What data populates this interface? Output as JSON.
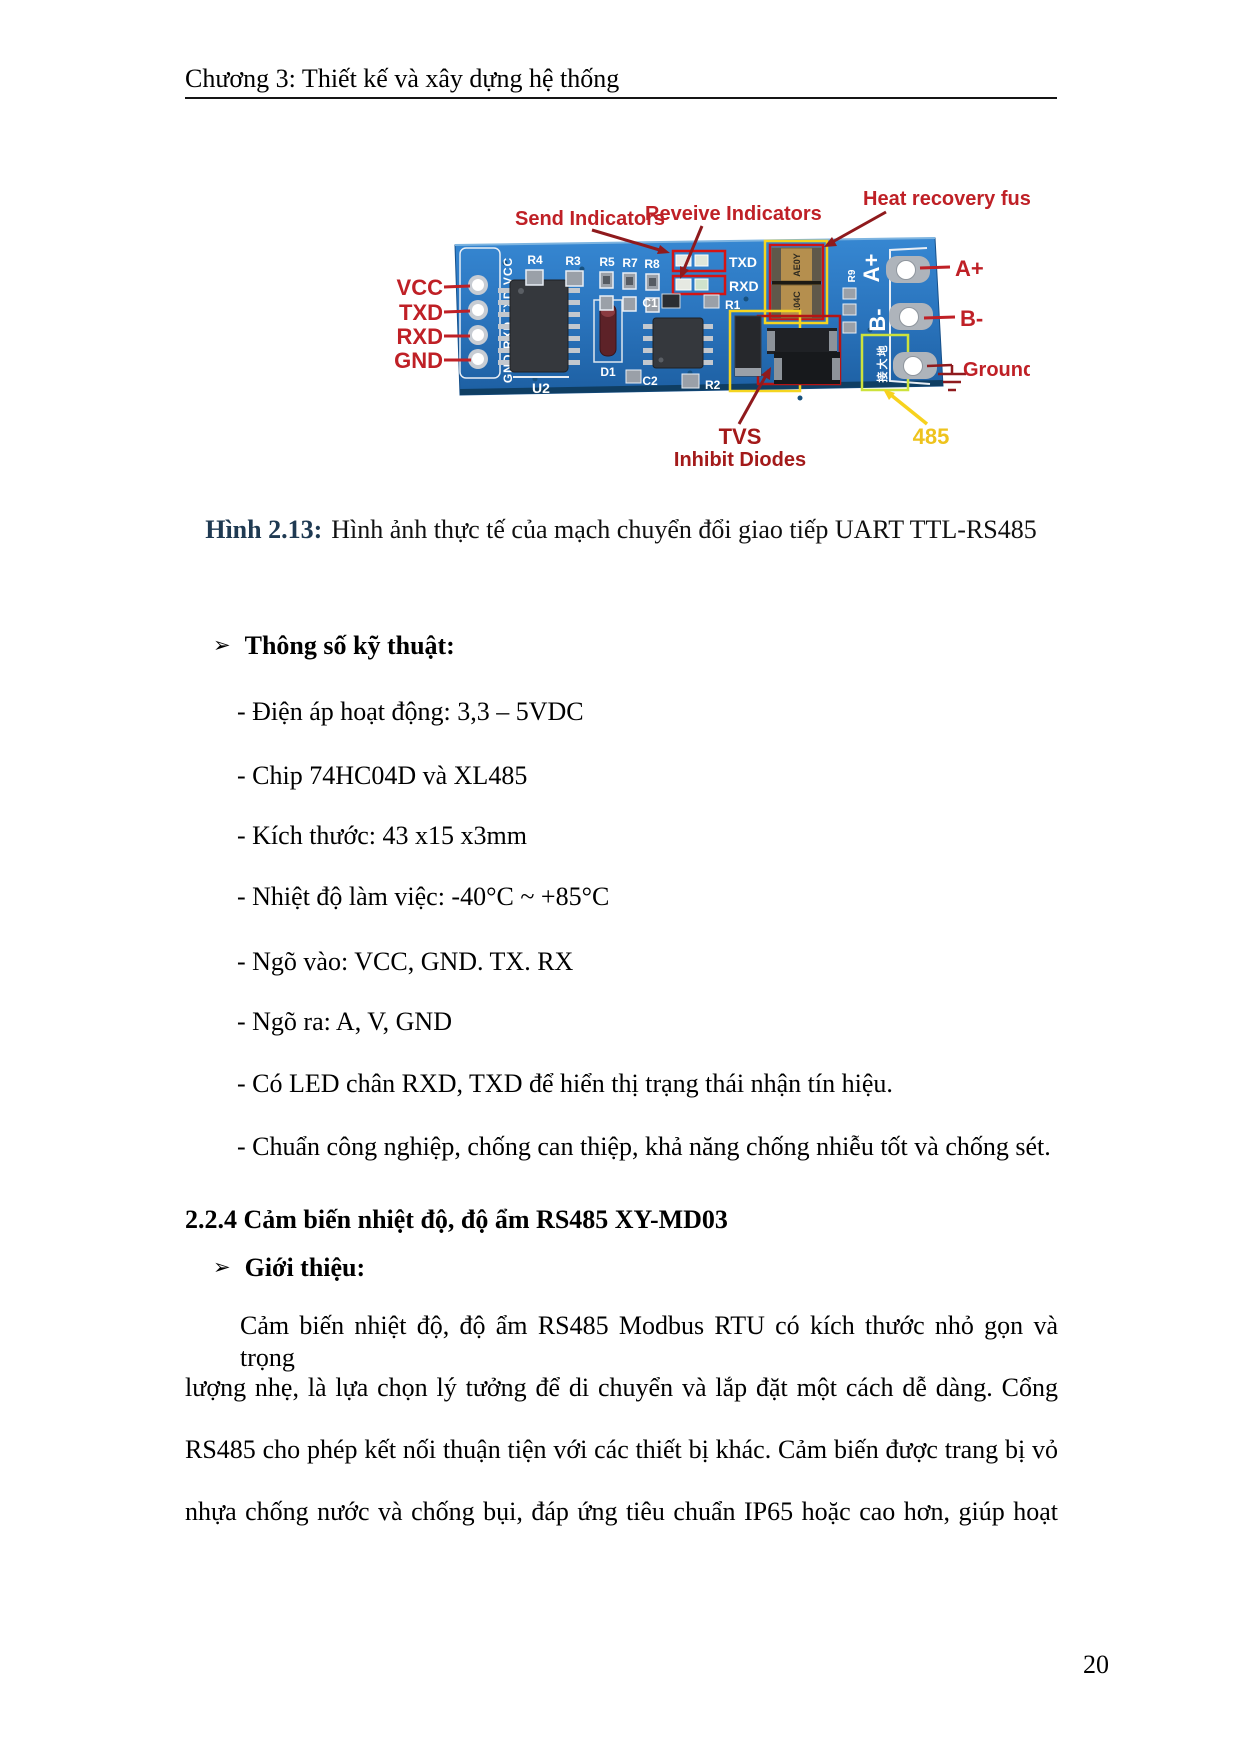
{
  "page": {
    "header": "Chương 3: Thiết kế và xây dựng hệ thống",
    "page_number": "20"
  },
  "figure": {
    "caption": {
      "label": "Hình 2.13:",
      "text": "Hình ảnh thực tế của mạch chuyển đổi giao tiếp UART TTL-RS485"
    },
    "labels": {
      "send": "Send Indicators",
      "receive": "Reveive Indicators",
      "fuse": "Heat recovery fuse",
      "vcc": "VCC",
      "txd": "TXD",
      "rxd": "RXD",
      "gnd": "GND",
      "a_plus": "A+",
      "b_minus": "B-",
      "ground": "Ground",
      "tvs": "TVS",
      "inhibit": "Inhibit Diodes",
      "n485": "485"
    },
    "board": {
      "pins_left": "GND RXD TXD VCC",
      "u2": "U2",
      "d1": "D1",
      "c1": "C1",
      "c2": "C2",
      "r1": "R1",
      "r2": "R2",
      "r3": "R3",
      "r4": "R4",
      "r5": "R5",
      "r7": "R7",
      "r8": "R8",
      "r9": "R9",
      "txd": "TXD",
      "rxd": "RXD",
      "a_plus": "A+",
      "b_minus": "B-",
      "ground_cn": "接大地",
      "fuse_top": "AE0Y",
      "fuse_bottom": "104C"
    },
    "colors": {
      "label_red": "#bf2026",
      "arrow_dark_red": "#8f1a1d",
      "yellow": "#f2c91e",
      "board_blue": "#2a74bd"
    }
  },
  "specs": {
    "bullet": "➢",
    "title": "Thông số kỹ thuật:",
    "items": [
      "- Điện áp hoạt động: 3,3 – 5VDC",
      "- Chip 74HC04D và XL485",
      "- Kích thước: 43 x15 x3mm",
      "- Nhiệt độ làm việc: -40°C ~ +85°C",
      "- Ngõ vào: VCC, GND. TX. RX",
      "- Ngõ ra: A, V, GND",
      "- Có LED chân RXD, TXD để hiển thị trạng thái nhận tín hiệu.",
      "- Chuẩn công nghiệp, chống can thiệp, khả năng chống nhiễu tốt và chống sét."
    ]
  },
  "section": {
    "heading": "2.2.4 Cảm biến nhiệt độ, độ ẩm RS485 XY-MD03",
    "bullet": "➢",
    "intro": "Giới thiệu:",
    "lines": [
      "Cảm biến nhiệt độ, độ ẩm RS485 Modbus RTU có kích thước nhỏ gọn và trọng",
      "lượng nhẹ, là lựa chọn lý tưởng để di chuyển và lắp đặt một cách dễ dàng. Cổng",
      "RS485 cho phép kết nối thuận tiện với các thiết bị khác. Cảm biến được trang bị vỏ",
      "nhựa chống nước và chống bụi, đáp ứng tiêu chuẩn IP65 hoặc cao hơn, giúp hoạt"
    ]
  }
}
